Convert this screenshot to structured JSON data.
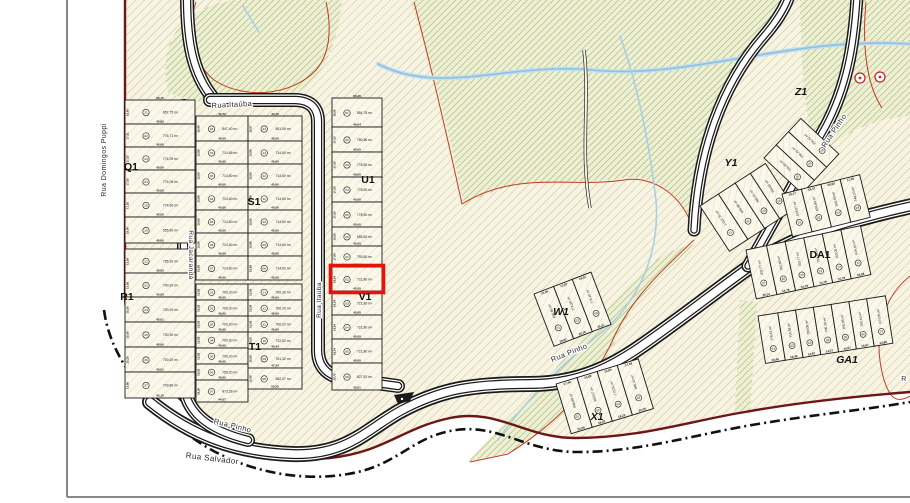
{
  "map_type": "subdivision-plat-plan",
  "highlight": {
    "block": "V1",
    "lot": "02",
    "area": "721,80 m²",
    "bottom_dim": "45,00",
    "side_dim": "16,04"
  },
  "colors": {
    "highlight": "#e8120c",
    "boundary": "#6e1616",
    "contour": "#c23b22",
    "water": "#8fc0dc",
    "road_casing": "#1a1a1a",
    "terrain_hatch": "#cfc091",
    "green_hatch": "#9fae62"
  },
  "streets": {
    "labels": [
      {
        "id": "rua-domingos-puppi",
        "text": "Rua Domingos Puppi",
        "x": 106,
        "y": 160,
        "rot": -90,
        "size": 7
      },
      {
        "id": "rua-itauba-top",
        "text": "Rua Itaúba",
        "x": 232,
        "y": 107,
        "rot": -3,
        "size": 7.5
      },
      {
        "id": "rua-jacaranda",
        "text": "Rua Jacarandá",
        "x": 189,
        "y": 255,
        "rot": 90,
        "size": 6.5
      },
      {
        "id": "rua-itauba-vertical",
        "text": "Rua Itaúba",
        "x": 321,
        "y": 300,
        "rot": -90,
        "size": 6.5
      },
      {
        "id": "rua-pinho-sw",
        "text": "Rua Pinho",
        "x": 232,
        "y": 428,
        "rot": 14,
        "size": 7.5
      },
      {
        "id": "rua-salvador",
        "text": "Rua Salvador",
        "x": 212,
        "y": 461,
        "rot": 7,
        "size": 8
      },
      {
        "id": "rua-pinho-mid",
        "text": "Rua Pinho",
        "x": 570,
        "y": 355,
        "rot": -22,
        "size": 7.5
      },
      {
        "id": "rua-pinho-ne",
        "text": "Rua Pinho",
        "x": 836,
        "y": 132,
        "rot": -56,
        "size": 7.5
      },
      {
        "id": "rua-partial-right",
        "text": "R",
        "x": 904,
        "y": 381,
        "rot": 0,
        "size": 7
      }
    ]
  },
  "block_labels": [
    {
      "text": "Q1",
      "x": 131,
      "y": 170,
      "it": false
    },
    {
      "text": "R1",
      "x": 127,
      "y": 300,
      "it": false
    },
    {
      "text": "S1",
      "x": 254,
      "y": 205,
      "it": false
    },
    {
      "text": "T1",
      "x": 255,
      "y": 350,
      "it": false
    },
    {
      "text": "U1",
      "x": 368,
      "y": 183,
      "it": false
    },
    {
      "text": "V1",
      "x": 365,
      "y": 300,
      "it": false
    },
    {
      "text": "W1",
      "x": 561,
      "y": 315,
      "it": true
    },
    {
      "text": "X1",
      "x": 597,
      "y": 420,
      "it": true
    },
    {
      "text": "Y1",
      "x": 731,
      "y": 166,
      "it": true
    },
    {
      "text": "Z1",
      "x": 801,
      "y": 95,
      "it": true
    },
    {
      "text": "DA1",
      "x": 820,
      "y": 258,
      "it": false
    },
    {
      "text": "GA1",
      "x": 847,
      "y": 363,
      "it": true
    }
  ],
  "blocks": [
    {
      "id": "q1",
      "x": 125,
      "y": 100,
      "w": 70,
      "lots": [
        {
          "n": "21",
          "a": "857,75 m²",
          "s": 24,
          "d": "45,86",
          "e": "16,65",
          "t": "66,15"
        },
        {
          "n": "22",
          "a": "776,71 m²",
          "s": 23,
          "d": "45,00",
          "e": "17,31"
        },
        {
          "n": "23",
          "a": "774,09 m²",
          "s": 23,
          "d": "45,00",
          "e": "17,25"
        },
        {
          "n": "24",
          "a": "774,09 m²",
          "s": 23,
          "d": "45,00",
          "e": "17,30"
        },
        {
          "n": "25",
          "a": "774,65 m²",
          "s": 24,
          "d": "45,00",
          "e": "17,20"
        },
        {
          "n": "26",
          "a": "655,90 m²",
          "s": 26,
          "d": "45,00",
          "e": "19,00"
        }
      ]
    },
    {
      "id": "r1",
      "x": 125,
      "y": 249,
      "w": 70,
      "lots": [
        {
          "n": "22",
          "a": "765,20 m²",
          "s": 24,
          "d": "45,00",
          "e": "15,56"
        },
        {
          "n": "23",
          "a": "700,20 m²",
          "s": 24,
          "d": "45,00",
          "e": "15,56"
        },
        {
          "n": "24",
          "a": "700,20 m²",
          "s": 25,
          "d": "45,01",
          "e": "15,56"
        },
        {
          "n": "25",
          "a": "700,30 m²",
          "s": 25,
          "d": "45,00",
          "e": "15,56"
        },
        {
          "n": "26",
          "a": "700,20 m²",
          "s": 25,
          "d": "45,01",
          "e": "15,20"
        },
        {
          "n": "27",
          "a": "703,80 m²",
          "s": 26,
          "d": "45,10",
          "e": "13,06"
        }
      ]
    },
    {
      "id": "s1-left",
      "x": 196,
      "y": 116,
      "w": 52,
      "lots": [
        {
          "n": "01",
          "a": "847,40 m²",
          "s": 25,
          "d": "45,00",
          "e": "18,46",
          "t": "43,72"
        },
        {
          "n": "02",
          "a": "714,65 m²",
          "s": 23,
          "d": "45,00",
          "e": "15,88"
        },
        {
          "n": "03",
          "a": "714,60 m²",
          "s": 23,
          "d": "45,00",
          "e": "15,88"
        },
        {
          "n": "04",
          "a": "714,60 m²",
          "s": 23,
          "d": "45,00",
          "e": "15,88"
        },
        {
          "n": "05",
          "a": "714,60 m²",
          "s": 23,
          "d": "45,00",
          "e": "15,88"
        },
        {
          "n": "06",
          "a": "714,60 m²",
          "s": 23,
          "d": "45,00",
          "e": "15,88"
        },
        {
          "n": "07",
          "a": "714,60 m²",
          "s": 24,
          "d": "45,00",
          "e": "15,88"
        }
      ]
    },
    {
      "id": "s1-right",
      "x": 248,
      "y": 116,
      "w": 54,
      "lots": [
        {
          "n": "14",
          "a": "851,06 m²",
          "s": 25,
          "d": "45,00",
          "e": "16,97",
          "t": "43,70"
        },
        {
          "n": "13",
          "a": "714,60 m²",
          "s": 23,
          "d": "45,00",
          "e": "15,88"
        },
        {
          "n": "12",
          "a": "714,60 m²",
          "s": 23,
          "d": "45,00",
          "e": "15,88"
        },
        {
          "n": "11",
          "a": "714,60 m²",
          "s": 23,
          "d": "45,00",
          "e": "15,88"
        },
        {
          "n": "10",
          "a": "714,60 m²",
          "s": 23,
          "d": "45,00",
          "e": "15,88"
        },
        {
          "n": "09",
          "a": "714,60 m²",
          "s": 23,
          "d": "45,00",
          "e": "15,88"
        },
        {
          "n": "08",
          "a": "714,60 m²",
          "s": 24,
          "d": "45,00",
          "e": "15,88"
        }
      ]
    },
    {
      "id": "t1-left",
      "x": 196,
      "y": 284,
      "w": 52,
      "lots": [
        {
          "n": "01",
          "a": "700,20 m²",
          "s": 16,
          "d": "45,00",
          "e": "15,56"
        },
        {
          "n": "02",
          "a": "700,20 m²",
          "s": 16,
          "d": "45,00",
          "e": "15,56"
        },
        {
          "n": "03",
          "a": "700,20 m²",
          "s": 16,
          "d": "45,00",
          "e": "15,56"
        },
        {
          "n": "04",
          "a": "700,20 m²",
          "s": 16,
          "d": "45,00",
          "e": "15,56"
        },
        {
          "n": "05",
          "a": "700,20 m²",
          "s": 16,
          "d": "45,00",
          "e": "15,56"
        },
        {
          "n": "06",
          "a": "759,20 m²",
          "s": 16,
          "d": "45,00",
          "e": "15,56"
        },
        {
          "n": "07",
          "a": "873,28 m²",
          "s": 22,
          "d": "44,07",
          "e": "19,30"
        }
      ]
    },
    {
      "id": "t1-right",
      "x": 248,
      "y": 284,
      "w": 54,
      "lots": [
        {
          "n": "13",
          "a": "700,30 m²",
          "s": 16,
          "d": "45,00",
          "e": "15,56"
        },
        {
          "n": "12",
          "a": "700,20 m²",
          "s": 16,
          "d": "45,00",
          "e": "15,56"
        },
        {
          "n": "11",
          "a": "700,20 m²",
          "s": 16,
          "d": "45,00",
          "e": "15,56"
        },
        {
          "n": "10",
          "a": "722,52 m²",
          "s": 17,
          "d": "45,44",
          "e": "16,05"
        },
        {
          "n": "09",
          "a": "761,32 m²",
          "s": 19,
          "d": "47,24",
          "e": "16,56"
        },
        {
          "n": "08",
          "a": "682,37 m²",
          "s": 21,
          "d": "50,25",
          "e": "12,48"
        }
      ]
    },
    {
      "id": "u1",
      "x": 332,
      "y": 98,
      "w": 50,
      "lots": [
        {
          "n": "01",
          "a": "854,78 m²",
          "s": 29,
          "d": "46,04",
          "e": "16,50",
          "t": "66,28"
        },
        {
          "n": "02",
          "a": "780,86 m²",
          "s": 25,
          "d": "45,00",
          "e": "17,50"
        },
        {
          "n": "03",
          "a": "778,50 m²",
          "s": 25,
          "d": "45,00",
          "e": "17,50"
        },
        {
          "n": "04",
          "a": "778,50 m²",
          "s": 25,
          "d": "45,00",
          "e": "17,50"
        },
        {
          "n": "05",
          "a": "778,50 m²",
          "s": 25,
          "d": "45,00",
          "e": "17,50"
        },
        {
          "n": "06",
          "a": "655,50 m²",
          "s": 19,
          "d": "45,00",
          "e": "19,50"
        }
      ]
    },
    {
      "id": "v1",
      "x": 332,
      "y": 246,
      "w": 50,
      "lots": [
        {
          "n": "01",
          "a": "793,80 m²",
          "s": 21,
          "d": "45,00",
          "e": "17,64"
        },
        {
          "n": "02",
          "a": "721,80 m²",
          "s": 24,
          "d": "45,00",
          "e": "16,04",
          "hl": true
        },
        {
          "n": "03",
          "a": "721,80 m²",
          "s": 24,
          "d": "45,00",
          "e": "16,04"
        },
        {
          "n": "04",
          "a": "721,80 m²",
          "s": 24,
          "d": "45,00",
          "e": "16,04"
        },
        {
          "n": "05",
          "a": "721,80 m²",
          "s": 24,
          "d": "45,00",
          "e": "16,04"
        },
        {
          "n": "06",
          "a": "827,52 m²",
          "s": 27,
          "d": "43,01",
          "e": "18,75"
        }
      ]
    },
    {
      "id": "w1",
      "x": 534,
      "y": 294,
      "rot": -21,
      "dir": "h",
      "w": 56,
      "lots": [
        {
          "n": "01",
          "a": "836,80 m²",
          "s": 21,
          "d": "28,02",
          "t": "13,00"
        },
        {
          "n": "02",
          "a": "774,38 m²",
          "s": 20,
          "d": "20,36",
          "t": "13,87"
        },
        {
          "n": "03",
          "a": "774,10 m²",
          "s": 20,
          "d": "19,21",
          "t": "18,51"
        }
      ]
    },
    {
      "id": "x1",
      "x": 556,
      "y": 384,
      "rot": -17,
      "dir": "h",
      "w": 52,
      "lots": [
        {
          "n": "01",
          "a": "846,89 m²",
          "s": 22,
          "d": "20,05",
          "t": "17,49"
        },
        {
          "n": "02",
          "a": "852,07 m²",
          "s": 21,
          "d": "19,23",
          "t": "15,69"
        },
        {
          "n": "03",
          "a": "772,01 m²",
          "s": 21,
          "d": "18,23",
          "t": "15,89"
        },
        {
          "n": "04",
          "a": "840,10 m²",
          "s": 22,
          "d": "20,05",
          "t": "17,49"
        }
      ]
    },
    {
      "id": "y1",
      "x": 700,
      "y": 206,
      "rot": -33,
      "dir": "h",
      "w": 54,
      "lots": [
        {
          "n": "01",
          "a": "1.012,75 m²",
          "s": 22
        },
        {
          "n": "02",
          "a": "944,98 m²",
          "s": 20
        },
        {
          "n": "03",
          "a": "769,70 m²",
          "s": 18
        },
        {
          "n": "04",
          "a": "764,60 m²",
          "s": 18
        }
      ]
    },
    {
      "id": "z1",
      "x": 764,
      "y": 158,
      "rot": -47,
      "dir": "h",
      "w": 52,
      "lots": [
        {
          "n": "01",
          "a": "766,60 m²",
          "s": 18
        },
        {
          "n": "02",
          "a": "766,42 m²",
          "s": 18
        },
        {
          "n": "03",
          "a": "756,42 m²",
          "s": 18
        }
      ]
    },
    {
      "id": "row-upper-right",
      "x": 782,
      "y": 194,
      "rot": -14,
      "dir": "h",
      "w": 44,
      "lots": [
        {
          "n": "01",
          "a": "834,57 m²",
          "s": 20,
          "t": "13,17"
        },
        {
          "n": "02",
          "a": "836,80 m²",
          "s": 20,
          "t": "18,37"
        },
        {
          "n": "03",
          "a": "818,60 m²",
          "s": 20,
          "t": "20,83"
        },
        {
          "n": "04",
          "a": "744,30 m²",
          "s": 20,
          "t": "17,35"
        }
      ]
    },
    {
      "id": "da1",
      "x": 746,
      "y": 250,
      "rot": -12,
      "dir": "h",
      "w": 50,
      "lots": [
        {
          "n": "27",
          "a": "832,77 m²",
          "s": 21,
          "d": "25,14"
        },
        {
          "n": "26",
          "a": "762,98 m²",
          "s": 19,
          "d": "14,78"
        },
        {
          "n": "25",
          "a": "703,77 m²",
          "s": 19,
          "d": "14,78"
        },
        {
          "n": "24",
          "a": "703,48 m²",
          "s": 19,
          "d": "14,79"
        },
        {
          "n": "23",
          "a": "703,08 m²",
          "s": 19,
          "d": "15,75"
        },
        {
          "n": "22",
          "a": "644,16 m²",
          "s": 20,
          "d": "18,58"
        }
      ]
    },
    {
      "id": "ga1",
      "x": 758,
      "y": 316,
      "rot": -9,
      "dir": "h",
      "w": 48,
      "lots": [
        {
          "n": "01",
          "a": "778,42 m²",
          "s": 20,
          "d": "15,49"
        },
        {
          "n": "02",
          "a": "716,38 m²",
          "s": 18,
          "d": "14,49"
        },
        {
          "n": "03",
          "a": "709,08 m²",
          "s": 18,
          "d": "14,87"
        },
        {
          "n": "04",
          "a": "700,10 m²",
          "s": 18,
          "d": "14,57"
        },
        {
          "n": "05",
          "a": "700,09 m²",
          "s": 18,
          "d": "14,57"
        },
        {
          "n": "06",
          "a": "705,10 m²",
          "s": 18,
          "d": "14,57"
        },
        {
          "n": "07",
          "a": "674,05 m²",
          "s": 19,
          "d": "14,89"
        }
      ]
    }
  ],
  "markers": {
    "survey_circles": [
      {
        "x": 860,
        "y": 78
      },
      {
        "x": 880,
        "y": 77
      }
    ],
    "small_structure": {
      "x": 398,
      "y": 398
    }
  }
}
